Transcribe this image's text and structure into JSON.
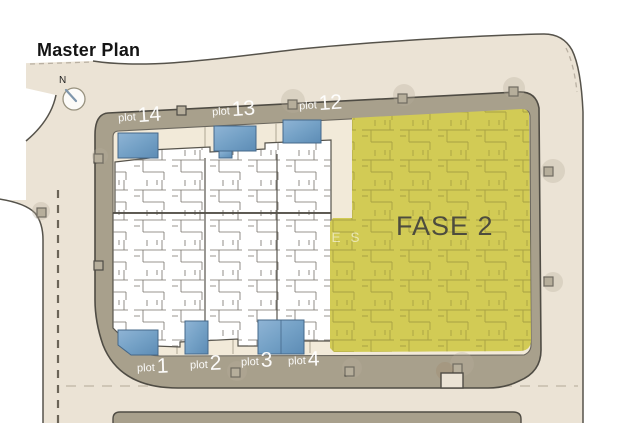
{
  "title": "Master Plan",
  "compass": {
    "label": "N"
  },
  "phase": {
    "label": "FASE 2"
  },
  "watermark": {
    "text": "RTIES"
  },
  "plots_top": [
    {
      "prefix": "plot",
      "number": "14"
    },
    {
      "prefix": "plot",
      "number": "13"
    },
    {
      "prefix": "plot",
      "number": "12"
    }
  ],
  "plots_bottom": [
    {
      "prefix": "plot",
      "number": "1"
    },
    {
      "prefix": "plot",
      "number": "2"
    },
    {
      "prefix": "plot",
      "number": "3"
    },
    {
      "prefix": "plot",
      "number": "4"
    }
  ],
  "colors": {
    "phase2_yellow": "#d2cb55",
    "road_band_taupe": "#a8a08c",
    "ground_beige": "#ebe3d5",
    "garden_cream": "#f2ead9",
    "pool_blue": "#7ea8cb",
    "outline_dark": "#4f4c44"
  }
}
